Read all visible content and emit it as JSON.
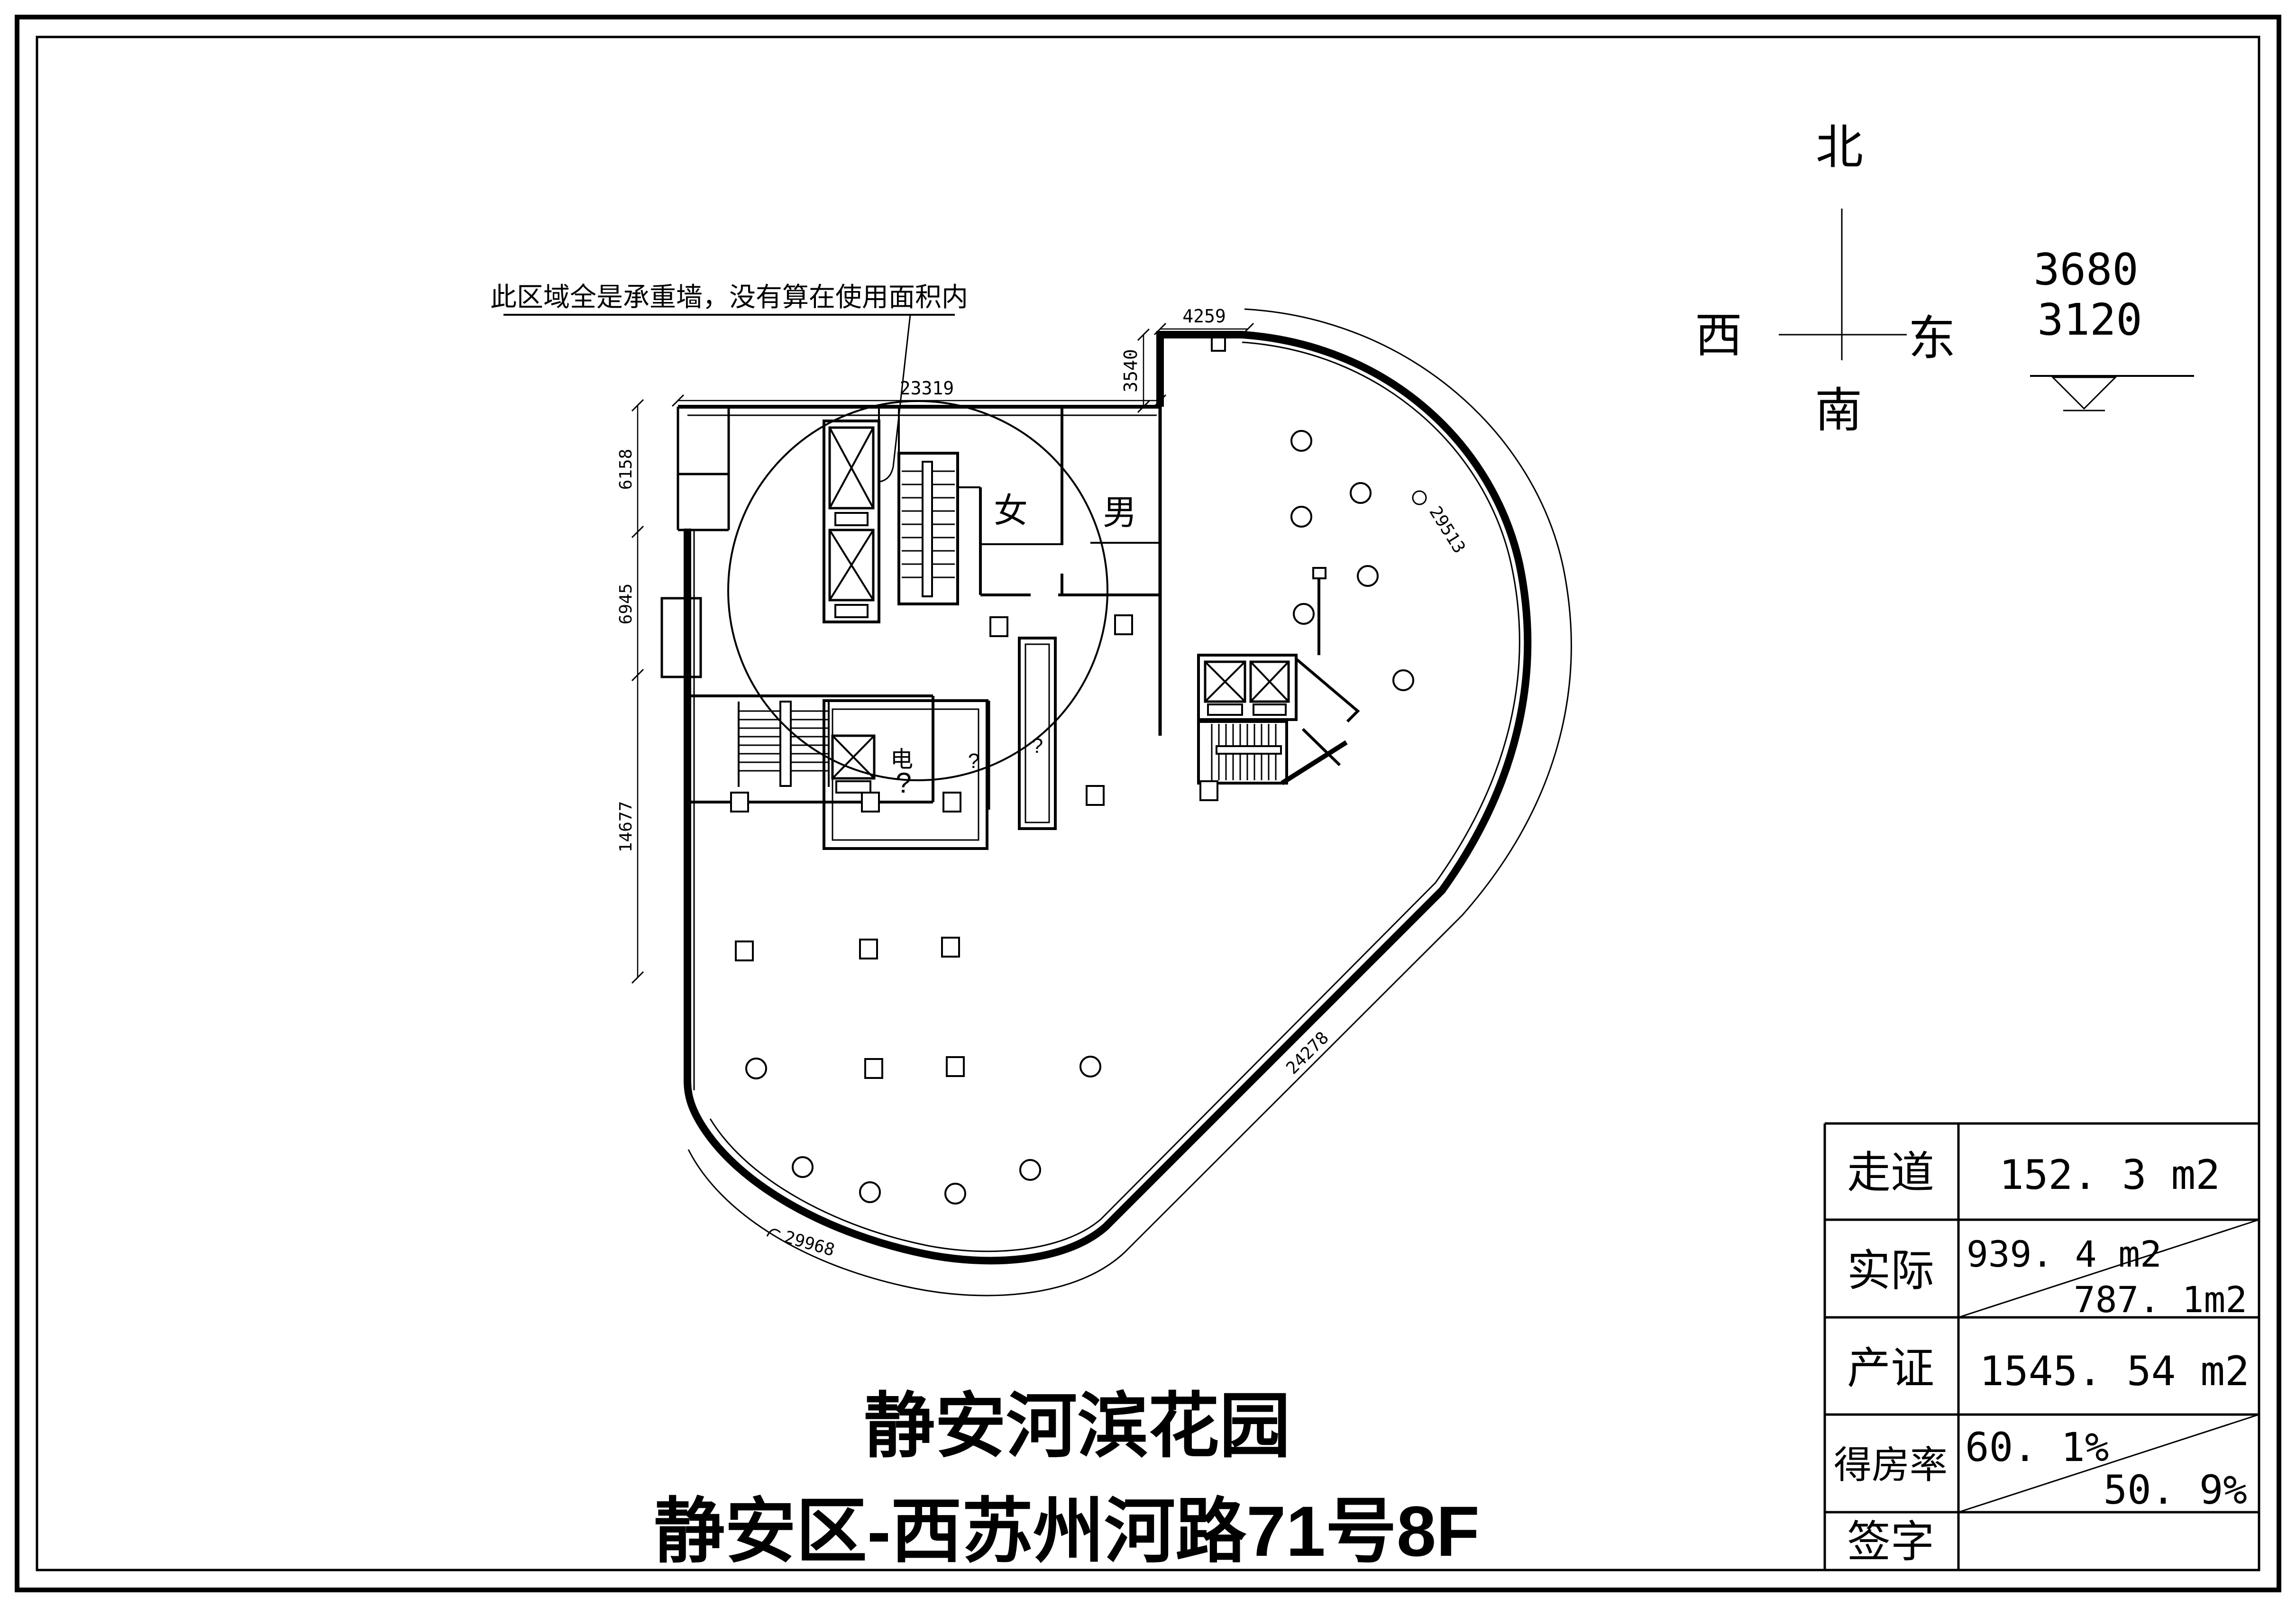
{
  "compass": {
    "north": "北",
    "south": "南",
    "west": "西",
    "east": "东"
  },
  "elevation": {
    "value_top": "3680",
    "value_bottom": "3120"
  },
  "annotation": {
    "note": "此区域全是承重墙，没有算在使用面积内"
  },
  "plan": {
    "labels": {
      "female": "女",
      "male": "男",
      "electric": "电",
      "room_q_large": "?",
      "room_q_small": "?",
      "corridor_q": "?"
    },
    "dimensions": {
      "top_width": "23319",
      "top_right_width": "4259",
      "top_right_height": "3540",
      "left_upper": "6158",
      "left_middle": "6945",
      "left_lower": "14677",
      "arc_right": "29513",
      "edge_diagonal": "24278",
      "arc_bottom": "29968"
    }
  },
  "area_table": {
    "rows": [
      {
        "label": "走道",
        "value": "152. 3 m2"
      },
      {
        "label": "实际",
        "value_top": "939. 4 m2",
        "value_bottom": "787. 1m2"
      },
      {
        "label": "产证",
        "value": "1545. 54 m2"
      },
      {
        "label": "得房率",
        "value_top": "60. 1%",
        "value_bottom": "50. 9%"
      },
      {
        "label": "签字",
        "value": ""
      }
    ]
  },
  "title": {
    "line1": "静安河滨花园",
    "line2": "静安区-西苏州河路71号8F"
  }
}
